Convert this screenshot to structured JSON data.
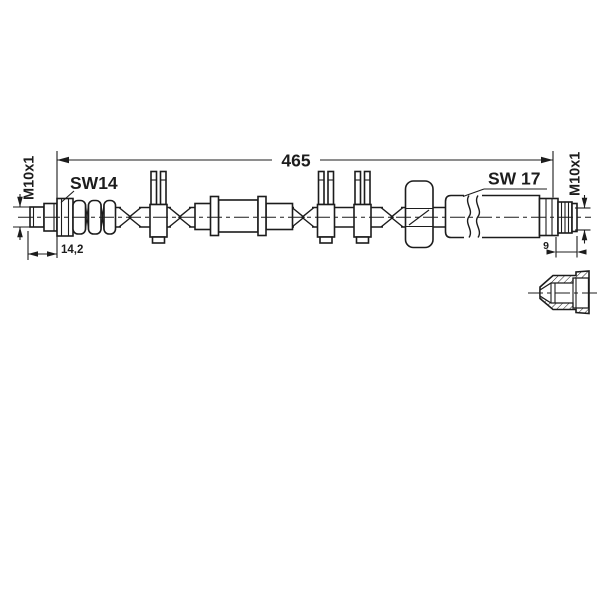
{
  "drawing": {
    "background_color": "#ffffff",
    "line_color": "#1c1c1c",
    "labels": {
      "overall_length": "465",
      "left_wrench_size": "SW14",
      "right_wrench_size": "SW 17",
      "left_thread": "M10x1",
      "right_thread": "M10x1",
      "left_fitting_length": "14,2",
      "right_thread_length": "9"
    }
  }
}
